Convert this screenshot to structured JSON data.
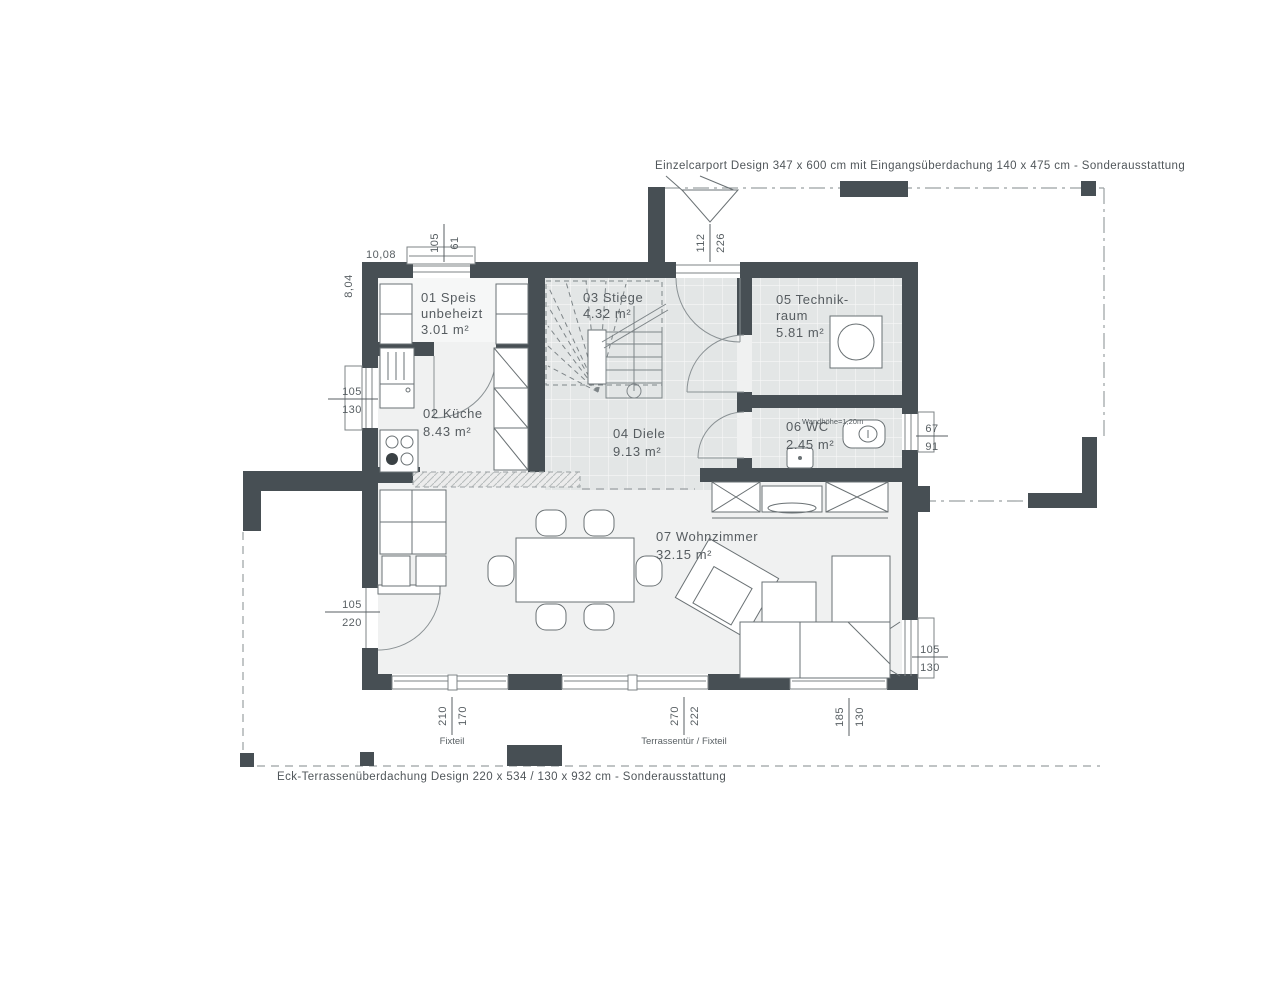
{
  "annotations": {
    "carport": "Einzelcarport Design 347 x 600 cm mit Eingangsüberdachung 140 x 475 cm  - Sonderausstattung",
    "terrace": "Eck-Terrassenüberdachung Design 220 x 534 / 130 x 932 cm - Sonderausstattung"
  },
  "rooms": {
    "speis": {
      "name": "01 Speis",
      "sub": "unbeheizt",
      "area": "3.01 m²"
    },
    "kueche": {
      "name": "02 Küche",
      "area": "8.43 m²"
    },
    "stiege": {
      "name": "03 Stiege",
      "area": "4.32 m²"
    },
    "diele": {
      "name": "04 Diele",
      "area": "9.13 m²"
    },
    "technik": {
      "name": "05 Technik-",
      "name2": "raum",
      "area": "5.81 m²"
    },
    "wc": {
      "name": "06 WC",
      "area": "2.45 m²",
      "note": "Wandhöhe=1,20m"
    },
    "wohnzimmer": {
      "name": "07 Wohnzimmer",
      "area": "32.15 m²"
    }
  },
  "dimensions": {
    "overall_width": "10,08",
    "overall_height": "8,04",
    "speis_window": {
      "w": "105",
      "h": "61"
    },
    "entry_door": {
      "w": "112",
      "h": "226"
    },
    "kitchen_window": {
      "w": "105",
      "h": "130"
    },
    "terrace_door_left": {
      "w": "105",
      "h": "220"
    },
    "wc_window": {
      "w": "67",
      "h": "91"
    },
    "living_window_right": {
      "w": "105",
      "h": "130"
    },
    "fix_window_bottom": {
      "w": "210",
      "h": "170",
      "label": "Fixteil"
    },
    "terrace_door_bottom": {
      "w": "270",
      "h": "222",
      "label": "Terrassentür / Fixteil"
    },
    "corner_window_bottom": {
      "w": "185",
      "h": "130"
    }
  },
  "colors": {
    "wall": "#474f54",
    "tile_floor": "#e3e6e6",
    "room_floor": "#f0f1f1",
    "annotation_text": "#50565a",
    "dimension_text": "#585f63"
  }
}
